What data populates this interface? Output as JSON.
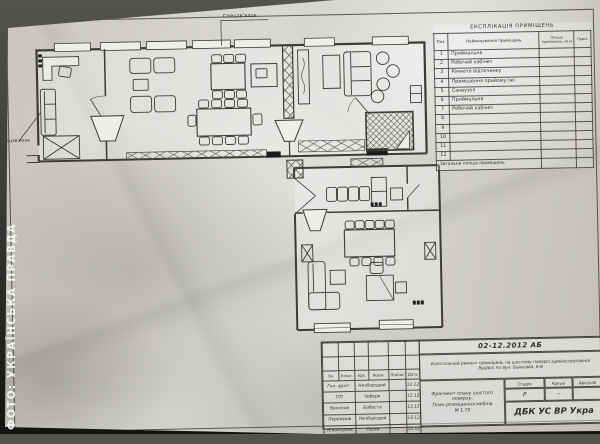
{
  "watermark": "ФОТО: УКРАЇНСЬКА ПРАВДА",
  "plan": {
    "label_top": "Спецзв'язок",
    "label_left": "Спецзв'язок"
  },
  "explication": {
    "title": "ЕКСПЛІКАЦІЯ ПРИМІЩЕНЬ",
    "col_pos": "Поз.",
    "col_name": "Найменування приміщень",
    "col_area": "Площа приміщень, кв.м",
    "col_note": "Прим.",
    "rows": [
      {
        "pos": "1",
        "name": "Приймальня"
      },
      {
        "pos": "2",
        "name": "Робочий кабінет"
      },
      {
        "pos": "3",
        "name": "Кімната відпочинку"
      },
      {
        "pos": "4",
        "name": "Приміщення прийому їжі"
      },
      {
        "pos": "5",
        "name": "Санвузол"
      },
      {
        "pos": "6",
        "name": "Приймальня"
      },
      {
        "pos": "7",
        "name": "Робочий кабінет"
      },
      {
        "pos": "8",
        "name": ""
      },
      {
        "pos": "9",
        "name": ""
      },
      {
        "pos": "10",
        "name": ""
      },
      {
        "pos": "11",
        "name": ""
      },
      {
        "pos": "12",
        "name": ""
      }
    ],
    "footer": "Загальна площа приміщень"
  },
  "title_block": {
    "doc_code": "02-12.2012 АБ",
    "project_line1": "Капітальний ремонт приміщень на шостому поверсі адміністративної",
    "project_line2": "будівлі по вул. Банковій, 6-8",
    "cols": [
      "Зм.",
      "Кільк.",
      "Арк.",
      "№док.",
      "Підпис",
      "Дата"
    ],
    "signers": [
      {
        "role": "Гол. архіт.",
        "name": "Незбородий",
        "date": "12.12"
      },
      {
        "role": "ГІП",
        "name": "Чеберя",
        "date": "12.12"
      },
      {
        "role": "Виконав",
        "name": "Бабеста",
        "date": "12.12"
      },
      {
        "role": "Перевірив",
        "name": "Незбородий",
        "date": "12.12"
      },
      {
        "role": "Н.контроль",
        "name": "Палій",
        "date": "12.12"
      }
    ],
    "stage_label": "Стадія",
    "sheet_label": "Аркуш",
    "sheets_label": "Аркушів",
    "stage": "Р",
    "sheet": "–",
    "sheets": "",
    "drawing_title_1": "Фрагмент плану шостого поверху.",
    "drawing_title_2": "План розміщення меблів",
    "drawing_title_3": "М 1:75",
    "organization": "ДБК УС ВР Укра"
  }
}
